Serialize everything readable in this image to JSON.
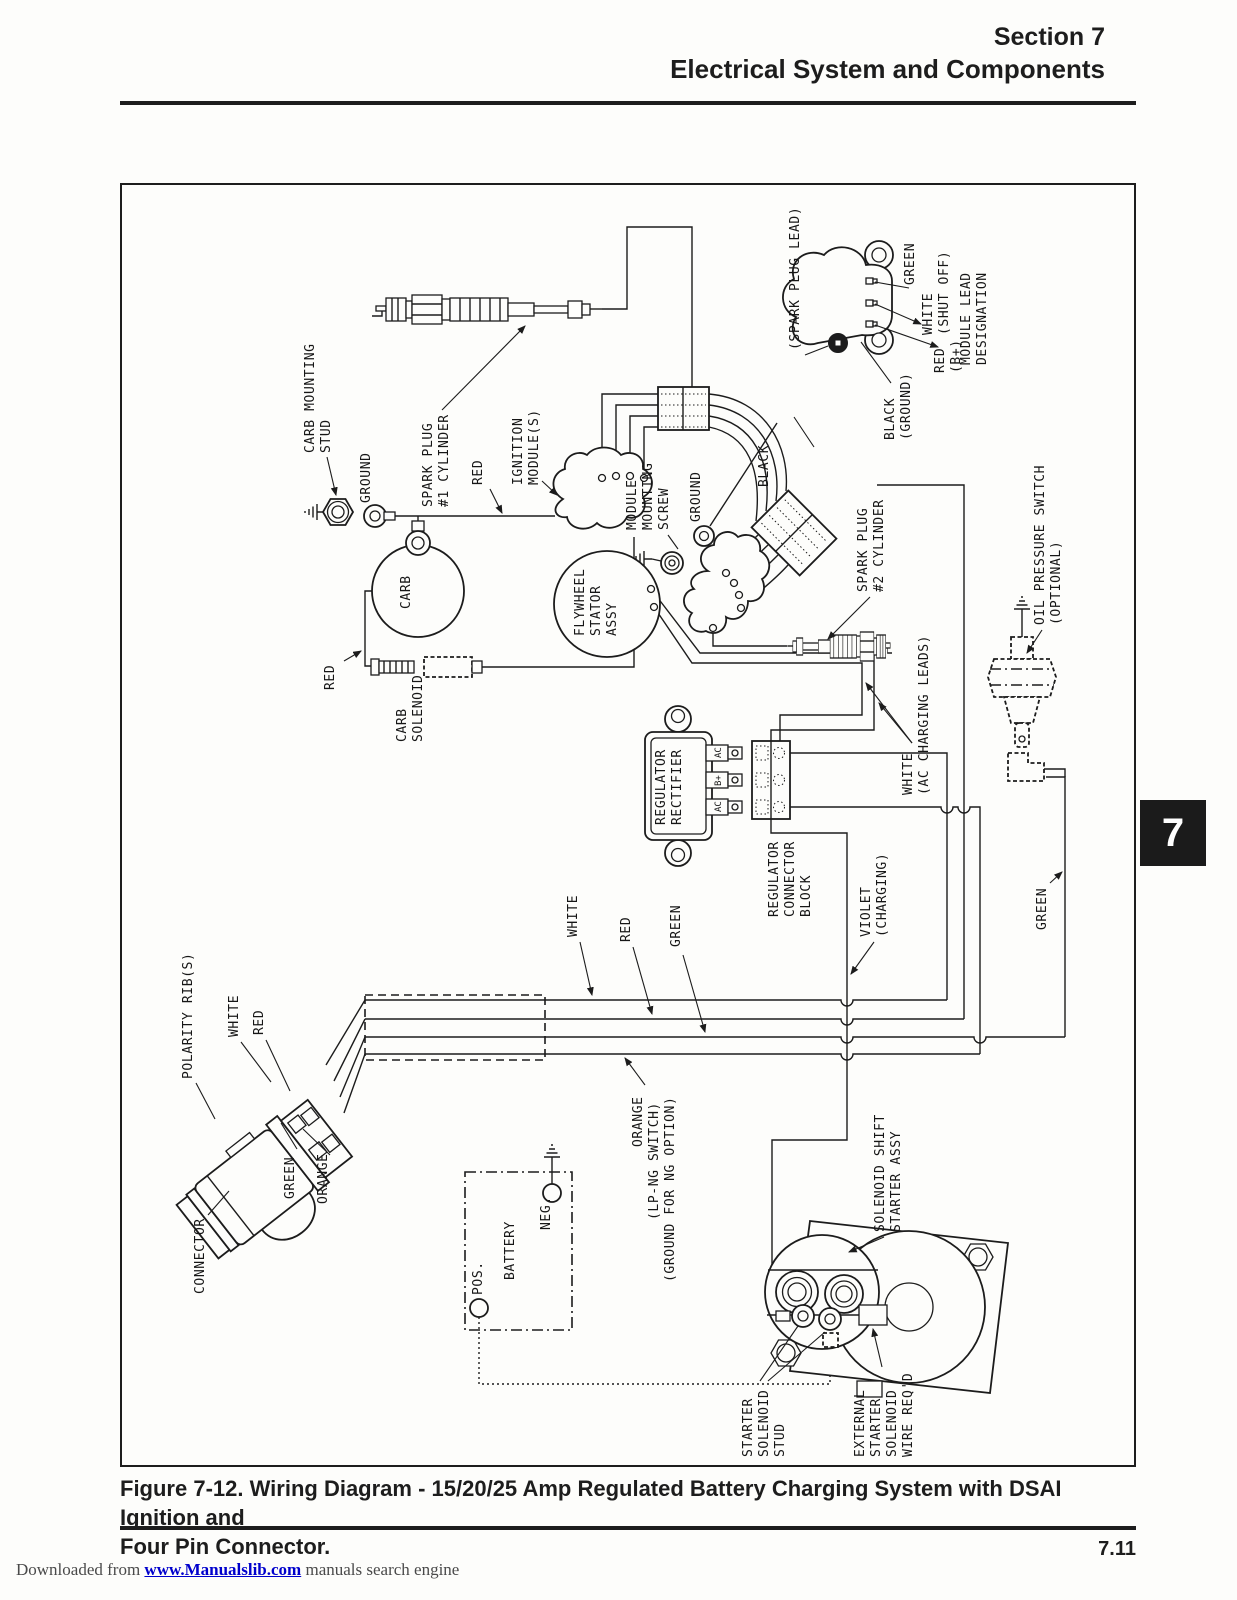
{
  "header": {
    "section": "Section 7",
    "title": "Electrical System and Components"
  },
  "figure": {
    "caption_line1": "Figure 7-12. Wiring Diagram - 15/20/25 Amp Regulated Battery Charging System with DSAI Ignition and",
    "caption_line2": "Four Pin Connector.",
    "page_number": "7.11",
    "chapter_tab": "7"
  },
  "footer": {
    "prefix": "Downloaded from ",
    "link": "www.Manualslib.com",
    "suffix": " manuals search engine"
  },
  "colors": {
    "ink": "#1c1c1c",
    "tab_bg": "#1b1b1b",
    "link_blue": "#0000cc"
  },
  "diagram": {
    "labels": {
      "spark_plug_lead": "(SPARK PLUG LEAD)",
      "module_green": "GREEN",
      "module_white": [
        "WHITE",
        "(SHUT OFF)"
      ],
      "module_red": [
        "RED",
        "(B+)"
      ],
      "module_lead_designation": [
        "MODULE LEAD",
        "DESIGNATION"
      ],
      "module_black": [
        "BLACK",
        "(GROUND)"
      ],
      "carb_mounting_stud": [
        "CARB MOUNTING",
        "STUD"
      ],
      "ground_left": "GROUND",
      "spark_plug_1": [
        "SPARK PLUG",
        "#1 CYLINDER"
      ],
      "red_top": "RED",
      "ignition_modules": [
        "IGNITION",
        "MODULE(S)"
      ],
      "red_left": "RED",
      "carb": "CARB",
      "carb_solenoid": [
        "CARB",
        "SOLENOID"
      ],
      "module_mounting_screw": [
        "MODULE",
        "MOUNTING",
        "SCREW"
      ],
      "ground_mid": "GROUND",
      "black_mid": "BLACK",
      "flywheel_stator": [
        "FLYWHEEL",
        "STATOR",
        "ASSY"
      ],
      "spark_plug_2": [
        "SPARK PLUG",
        "#2 CYLINDER"
      ],
      "oil_pressure_switch": [
        "OIL PRESSURE SWITCH",
        "(OPTIONAL)"
      ],
      "regulator_rectifier": [
        "REGULATOR",
        "RECTIFIER"
      ],
      "terminal_ac_top": "AC",
      "terminal_b_plus": "B+",
      "terminal_ac_bottom": "AC",
      "regulator_connector_block": [
        "REGULATOR",
        "CONNECTOR",
        "BLOCK"
      ],
      "white_ac_charging": [
        "WHITE",
        "(AC CHARGING LEADS)"
      ],
      "violet_charging": [
        "VIOLET",
        "(CHARGING)"
      ],
      "green_right": "GREEN",
      "white_mid": "WHITE",
      "red_mid": "RED",
      "green_mid": "GREEN",
      "polarity_ribs": "POLARITY RIB(S)",
      "white_conn": "WHITE",
      "red_conn": "RED",
      "green_conn": "GREEN",
      "orange_conn": "ORANGE",
      "connector": "CONNECTOR",
      "orange_lpng": [
        "ORANGE",
        "(LP-NG SWITCH)",
        "(GROUND FOR NG OPTION)"
      ],
      "battery": "BATTERY",
      "battery_pos": "POS.",
      "battery_neg": "NEG.",
      "solenoid_shift_starter": [
        "SOLENOID SHIFT",
        "STARTER ASSY"
      ],
      "starter_solenoid_stud": [
        "STARTER",
        "SOLENOID",
        "STUD"
      ],
      "external_starter_solenoid": [
        "EXTERNAL",
        "STARTER",
        "SOLENOID",
        "WIRE REQ'D"
      ]
    }
  }
}
